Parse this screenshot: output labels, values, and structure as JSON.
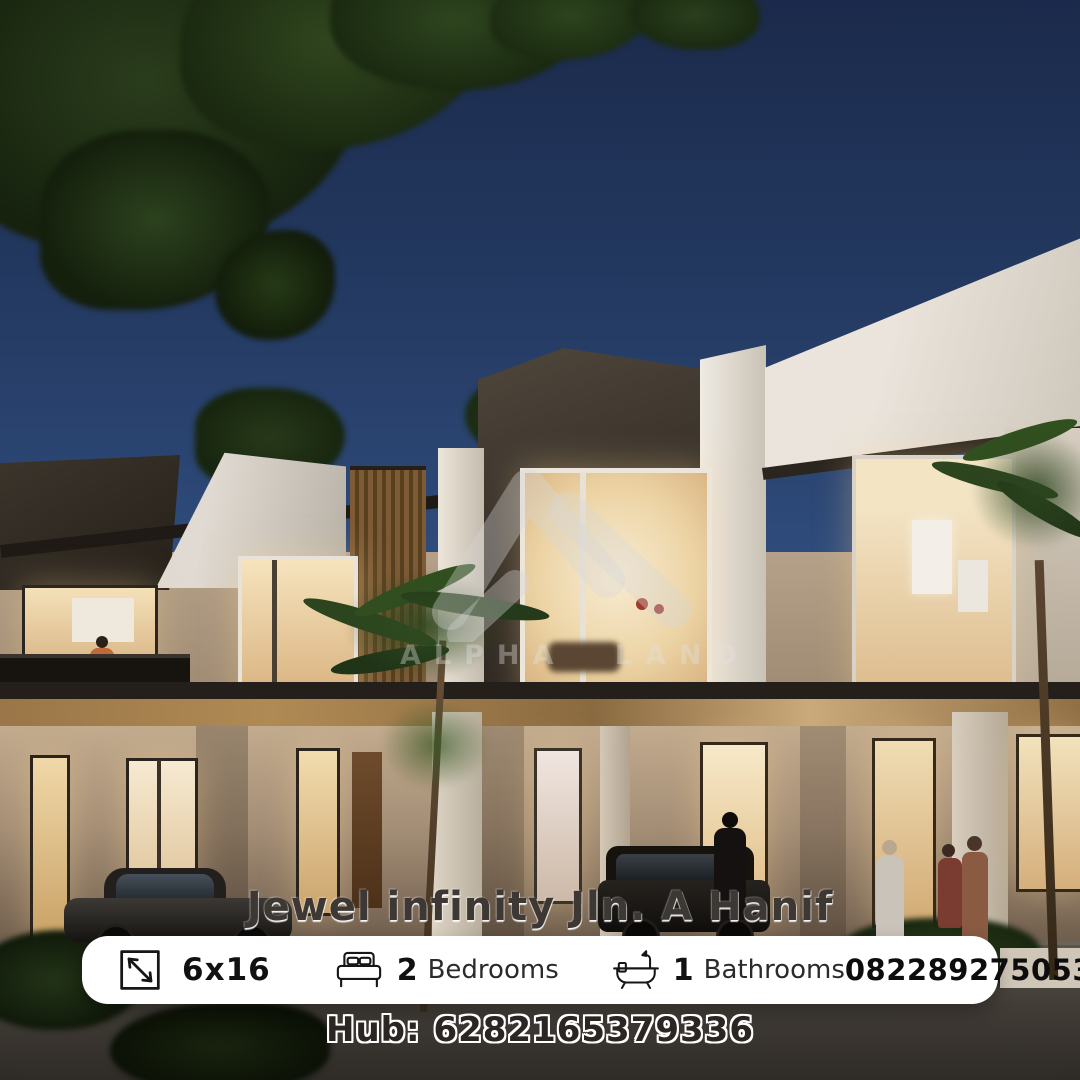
{
  "watermark": {
    "logo_icon": "alpha-land-logo",
    "brand": "ALPHA LAND"
  },
  "title": "Jewel infinity Jln. A Hanif",
  "info_bar": {
    "size_icon": "dimension-arrow-icon",
    "size_value": "6x16",
    "bedrooms_icon": "bed-icon",
    "bedrooms_count": "2",
    "bedrooms_label": "Bedrooms",
    "bathrooms_icon": "bathtub-icon",
    "bathrooms_count": "1",
    "bathrooms_label": "Bathrooms",
    "phone": "082289275053"
  },
  "footer": {
    "hub": "Hub: 6282165379336"
  },
  "colors": {
    "sky_top": "#1b2a4b",
    "sky_horizon": "#5b7899",
    "warm_window": "#f2ddb0",
    "wood_soffit": "#9a7648",
    "card_bg": "#ffffff",
    "text_primary": "#111111",
    "road": "#3f3a35"
  }
}
